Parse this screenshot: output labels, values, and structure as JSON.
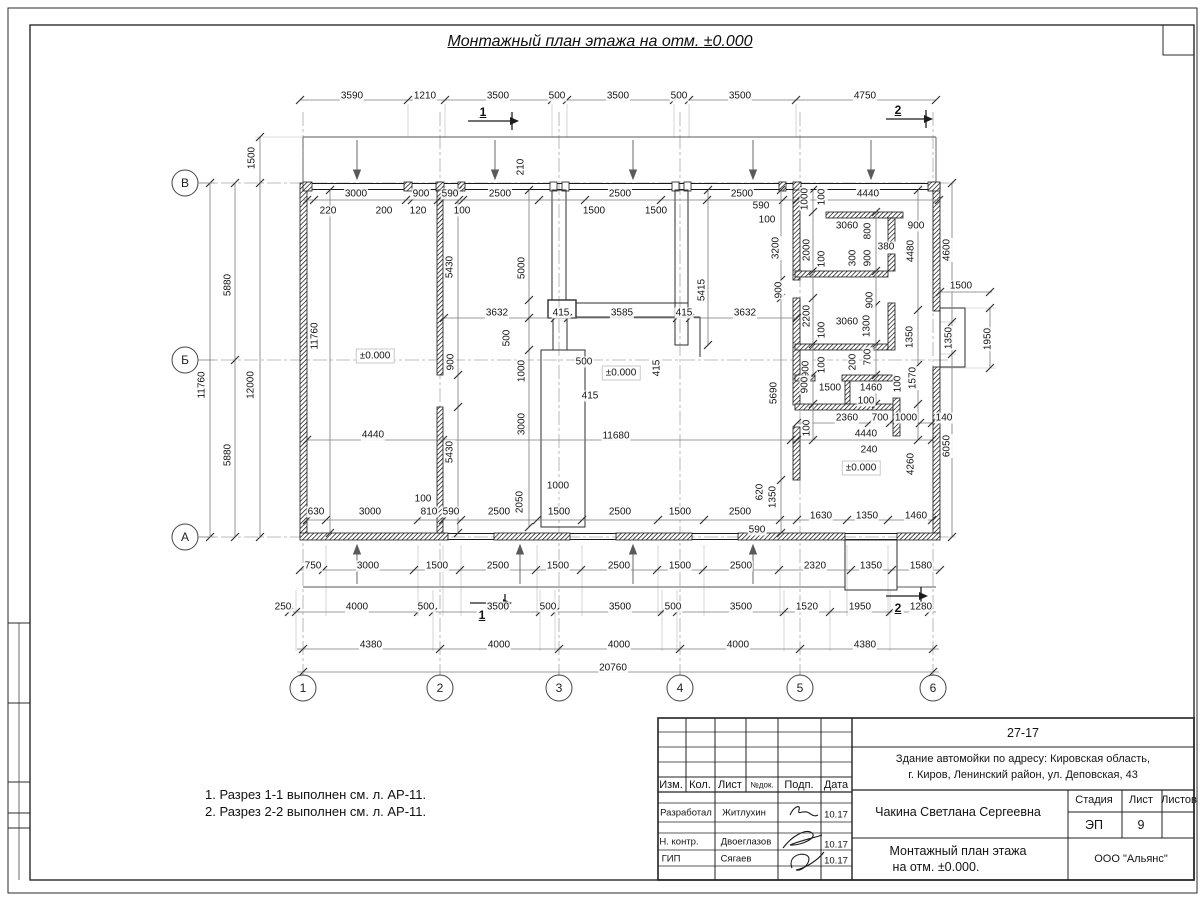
{
  "colors": {
    "wall": "#1a1a1a",
    "dimline": "#7a7a7a",
    "tick": "#333333",
    "axis": "#9a9a9a",
    "text": "#141414"
  },
  "title": "Монтажный план этажа на отм. ±0.000",
  "notes": [
    "1. Разрез 1-1 выполнен см. л. АР-11.",
    "2. Разрез 2-2 выполнен см. л. АР-11."
  ],
  "axes": {
    "left": [
      {
        "label": "В",
        "x": 185,
        "y": 183
      },
      {
        "label": "Б",
        "x": 185,
        "y": 360
      },
      {
        "label": "А",
        "x": 185,
        "y": 537
      }
    ],
    "bottom": [
      {
        "label": "1",
        "x": 303,
        "y": 688
      },
      {
        "label": "2",
        "x": 440,
        "y": 688
      },
      {
        "label": "3",
        "x": 559,
        "y": 688
      },
      {
        "label": "4",
        "x": 680,
        "y": 688
      },
      {
        "label": "5",
        "x": 800,
        "y": 688
      },
      {
        "label": "6",
        "x": 933,
        "y": 688
      }
    ]
  },
  "sections": [
    {
      "label": "1",
      "tx": 483,
      "ty": 112,
      "line": [
        468,
        121,
        510,
        121
      ],
      "head": [
        510,
        121
      ],
      "bar": [
        512,
        112,
        130
      ]
    },
    {
      "label": "2",
      "tx": 898,
      "ty": 110,
      "line": [
        886,
        119,
        924,
        119
      ],
      "head": [
        924,
        119
      ],
      "bar": [
        926,
        110,
        128
      ]
    },
    {
      "label": "1",
      "tx": 482,
      "ty": 615,
      "line": [
        470,
        603,
        503,
        603
      ],
      "head": [
        503,
        603
      ],
      "bar": [
        505,
        594,
        612
      ]
    },
    {
      "label": "2",
      "tx": 898,
      "ty": 608,
      "line": [
        886,
        596,
        919,
        596
      ],
      "head": [
        919,
        596
      ],
      "bar": [
        921,
        587,
        605
      ]
    }
  ],
  "dims": [
    [
      "3590",
      352,
      96
    ],
    [
      "1210",
      425,
      96
    ],
    [
      "3500",
      498,
      96
    ],
    [
      "500",
      557,
      96
    ],
    [
      "3500",
      618,
      96
    ],
    [
      "500",
      679,
      96
    ],
    [
      "3500",
      740,
      96
    ],
    [
      "4750",
      865,
      96
    ],
    [
      "3000",
      356,
      194
    ],
    [
      "900",
      421,
      194
    ],
    [
      "590",
      450,
      194
    ],
    [
      "2500",
      500,
      194
    ],
    [
      "2500",
      620,
      194
    ],
    [
      "2500",
      742,
      194
    ],
    [
      "4440",
      868,
      194
    ],
    [
      "220",
      328,
      211
    ],
    [
      "200",
      384,
      211
    ],
    [
      "120",
      418,
      211
    ],
    [
      "100",
      462,
      211
    ],
    [
      "1500",
      594,
      211
    ],
    [
      "1500",
      656,
      211
    ],
    [
      "590",
      761,
      206
    ],
    [
      "100",
      767,
      220
    ],
    [
      "1500",
      252,
      158,
      1
    ],
    [
      "210",
      521,
      167,
      1
    ],
    [
      "5880",
      228,
      285,
      1
    ],
    [
      "11760",
      202,
      385,
      1
    ],
    [
      "12000",
      251,
      385,
      1
    ],
    [
      "5880",
      228,
      455,
      1
    ],
    [
      "11760",
      315,
      336,
      1
    ],
    [
      "±0.000",
      375,
      356
    ],
    [
      "4440",
      373,
      435
    ],
    [
      "5430",
      450,
      267,
      1
    ],
    [
      "900",
      451,
      362,
      1
    ],
    [
      "5430",
      450,
      452,
      1
    ],
    [
      "5000",
      522,
      268,
      1
    ],
    [
      "500",
      507,
      338,
      1
    ],
    [
      "1000",
      522,
      371,
      1
    ],
    [
      "3000",
      522,
      424,
      1
    ],
    [
      "2050",
      520,
      502,
      1
    ],
    [
      "5415",
      702,
      290,
      1
    ],
    [
      "415",
      657,
      368,
      1
    ],
    [
      "500",
      584,
      362
    ],
    [
      "415",
      590,
      396
    ],
    [
      "±0.000",
      621,
      373
    ],
    [
      "11680",
      616,
      436
    ],
    [
      "1000",
      558,
      486
    ],
    [
      "3632",
      497,
      313
    ],
    [
      "415",
      561,
      313
    ],
    [
      "3585",
      622,
      313
    ],
    [
      "415",
      684,
      313
    ],
    [
      "3632",
      745,
      313
    ],
    [
      "3200",
      776,
      248,
      1
    ],
    [
      "900",
      779,
      290,
      1
    ],
    [
      "2200",
      807,
      316,
      1
    ],
    [
      "5690",
      774,
      393,
      1
    ],
    [
      "620",
      760,
      492,
      1
    ],
    [
      "1350",
      773,
      497,
      1
    ],
    [
      "590",
      757,
      530
    ],
    [
      "1000",
      805,
      199,
      1
    ],
    [
      "100",
      822,
      197,
      1
    ],
    [
      "3060",
      847,
      226
    ],
    [
      "800",
      868,
      231,
      1
    ],
    [
      "900",
      916,
      226
    ],
    [
      "2000",
      807,
      250,
      1
    ],
    [
      "380",
      886,
      247
    ],
    [
      "300",
      853,
      258,
      1
    ],
    [
      "900",
      868,
      258,
      1
    ],
    [
      "100",
      822,
      259,
      1
    ],
    [
      "4480",
      911,
      251,
      1
    ],
    [
      "4600",
      947,
      250,
      1
    ],
    [
      "3060",
      847,
      322
    ],
    [
      "1300",
      867,
      326,
      1
    ],
    [
      "100",
      822,
      330,
      1
    ],
    [
      "900",
      870,
      300,
      1
    ],
    [
      "1350",
      910,
      337,
      1
    ],
    [
      "1500",
      961,
      286
    ],
    [
      "1350",
      949,
      338,
      1
    ],
    [
      "1950",
      988,
      339,
      1
    ],
    [
      "700",
      868,
      357,
      1
    ],
    [
      "200",
      853,
      362,
      1
    ],
    [
      "100",
      822,
      365,
      1
    ],
    [
      "900",
      806,
      369,
      1
    ],
    [
      "900",
      805,
      385,
      1
    ],
    [
      "1500",
      830,
      388
    ],
    [
      "1460",
      871,
      388
    ],
    [
      "100",
      898,
      384,
      1
    ],
    [
      "100",
      866,
      401
    ],
    [
      "1570",
      913,
      378,
      1
    ],
    [
      "2360",
      847,
      418
    ],
    [
      "700",
      880,
      418
    ],
    [
      "1000",
      906,
      418
    ],
    [
      "140",
      944,
      418
    ],
    [
      "100",
      807,
      428,
      1
    ],
    [
      "4440",
      866,
      434
    ],
    [
      "240",
      869,
      450
    ],
    [
      "±0.000",
      861,
      468
    ],
    [
      "4260",
      911,
      464,
      1
    ],
    [
      "6050",
      947,
      446,
      1
    ],
    [
      "630",
      316,
      512
    ],
    [
      "3000",
      370,
      512
    ],
    [
      "810",
      429,
      512
    ],
    [
      "590",
      451,
      512
    ],
    [
      "2500",
      499,
      512
    ],
    [
      "1500",
      559,
      512
    ],
    [
      "2500",
      620,
      512
    ],
    [
      "1500",
      680,
      512
    ],
    [
      "2500",
      740,
      512
    ],
    [
      "100",
      423,
      499
    ],
    [
      "1630",
      821,
      516
    ],
    [
      "1350",
      867,
      516
    ],
    [
      "1460",
      916,
      516
    ],
    [
      "750",
      313,
      566
    ],
    [
      "3000",
      368,
      566
    ],
    [
      "1500",
      437,
      566
    ],
    [
      "2500",
      498,
      566
    ],
    [
      "1500",
      558,
      566
    ],
    [
      "2500",
      619,
      566
    ],
    [
      "1500",
      680,
      566
    ],
    [
      "2500",
      741,
      566
    ],
    [
      "2320",
      815,
      566
    ],
    [
      "1350",
      871,
      566
    ],
    [
      "1580",
      921,
      566
    ],
    [
      "250",
      283,
      607
    ],
    [
      "4000",
      357,
      607
    ],
    [
      "500",
      426,
      607
    ],
    [
      "3500",
      498,
      607
    ],
    [
      "500",
      548,
      607
    ],
    [
      "3500",
      620,
      607
    ],
    [
      "500",
      673,
      607
    ],
    [
      "3500",
      741,
      607
    ],
    [
      "1520",
      807,
      607
    ],
    [
      "1950",
      860,
      607
    ],
    [
      "1280",
      921,
      607
    ],
    [
      "4380",
      371,
      645
    ],
    [
      "4000",
      499,
      645
    ],
    [
      "4000",
      619,
      645
    ],
    [
      "4000",
      738,
      645
    ],
    [
      "4380",
      865,
      645
    ],
    [
      "20760",
      613,
      668
    ]
  ],
  "title_block": {
    "texts": [
      {
        "t": "27-17",
        "x": 1023,
        "y": 733,
        "c": "tb-lg"
      },
      {
        "t": "Здание автомойки по адресу: Кировская область,",
        "x": 1023,
        "y": 759,
        "c": "tb-md"
      },
      {
        "t": "г. Киров, Ленинский район, ул. Деповская, 43",
        "x": 1023,
        "y": 775,
        "c": "tb-md"
      },
      {
        "t": "Изм.",
        "x": 671,
        "y": 785,
        "c": "tb-md"
      },
      {
        "t": "Кол.",
        "x": 700,
        "y": 785,
        "c": "tb-md"
      },
      {
        "t": "Лист",
        "x": 730,
        "y": 785,
        "c": "tb-md"
      },
      {
        "t": "№док.",
        "x": 762,
        "y": 785,
        "c": "tb-xs"
      },
      {
        "t": "Подп.",
        "x": 799,
        "y": 785,
        "c": "tb-md"
      },
      {
        "t": "Дата",
        "x": 836,
        "y": 785,
        "c": "tb-md"
      },
      {
        "t": "Разработал",
        "x": 686,
        "y": 813,
        "c": "tb-sm"
      },
      {
        "t": "Житлухин",
        "x": 744,
        "y": 813,
        "c": "tb-sm"
      },
      {
        "t": "10.17",
        "x": 836,
        "y": 815,
        "c": "tb-sm"
      },
      {
        "t": "Н. контр.",
        "x": 679,
        "y": 842,
        "c": "tb-sm"
      },
      {
        "t": "Двоеглазов",
        "x": 746,
        "y": 842,
        "c": "tb-sm"
      },
      {
        "t": "10.17",
        "x": 836,
        "y": 845,
        "c": "tb-sm"
      },
      {
        "t": "ГИП",
        "x": 671,
        "y": 859,
        "c": "tb-sm"
      },
      {
        "t": "Сягаев",
        "x": 736,
        "y": 859,
        "c": "tb-sm"
      },
      {
        "t": "10.17",
        "x": 836,
        "y": 861,
        "c": "tb-sm"
      },
      {
        "t": "Чакина Светлана Сергеевна",
        "x": 958,
        "y": 812,
        "c": "tb-lg"
      },
      {
        "t": "Стадия",
        "x": 1094,
        "y": 800,
        "c": "tb-md"
      },
      {
        "t": "Лист",
        "x": 1141,
        "y": 800,
        "c": "tb-md"
      },
      {
        "t": "Листов",
        "x": 1179,
        "y": 800,
        "c": "tb-md"
      },
      {
        "t": "ЭП",
        "x": 1094,
        "y": 825,
        "c": "tb-lg"
      },
      {
        "t": "9",
        "x": 1141,
        "y": 825,
        "c": "tb-lg"
      },
      {
        "t": "Монтажный план этажа",
        "x": 958,
        "y": 851,
        "c": "tb-lg"
      },
      {
        "t": "на отм. ±0.000.",
        "x": 936,
        "y": 867,
        "c": "tb-lg"
      },
      {
        "t": "ООО \"Альянс\"",
        "x": 1131,
        "y": 859,
        "c": "tb-md"
      }
    ]
  }
}
